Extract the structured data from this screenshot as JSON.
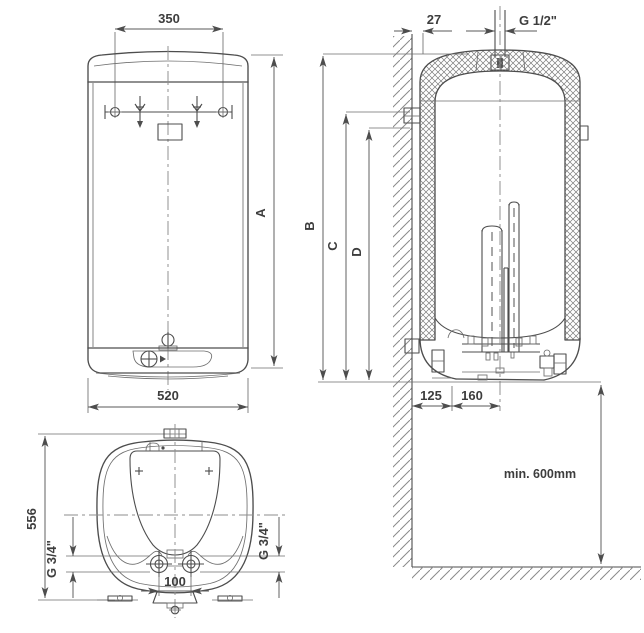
{
  "page": {
    "background": "#ffffff",
    "ink": "#4d4d4d",
    "text_color": "#3d3d3d"
  },
  "front_view": {
    "dim_top_width": "350",
    "dim_height": "A",
    "dim_bottom_width": "520"
  },
  "section_view": {
    "dim_wall_gap": "27",
    "top_connection": "G 1/2\"",
    "dim_total_height": "B",
    "dim_bracket_upper": "C",
    "dim_bracket_lower": "D",
    "dim_wall_offset": "125",
    "dim_center_offset": "160",
    "clearance_note": "min. 600mm"
  },
  "bottom_view": {
    "dim_depth": "556",
    "left_connection": "G 3/4\"",
    "right_connection": "G 3/4\"",
    "dim_pipe_spacing": "100"
  }
}
